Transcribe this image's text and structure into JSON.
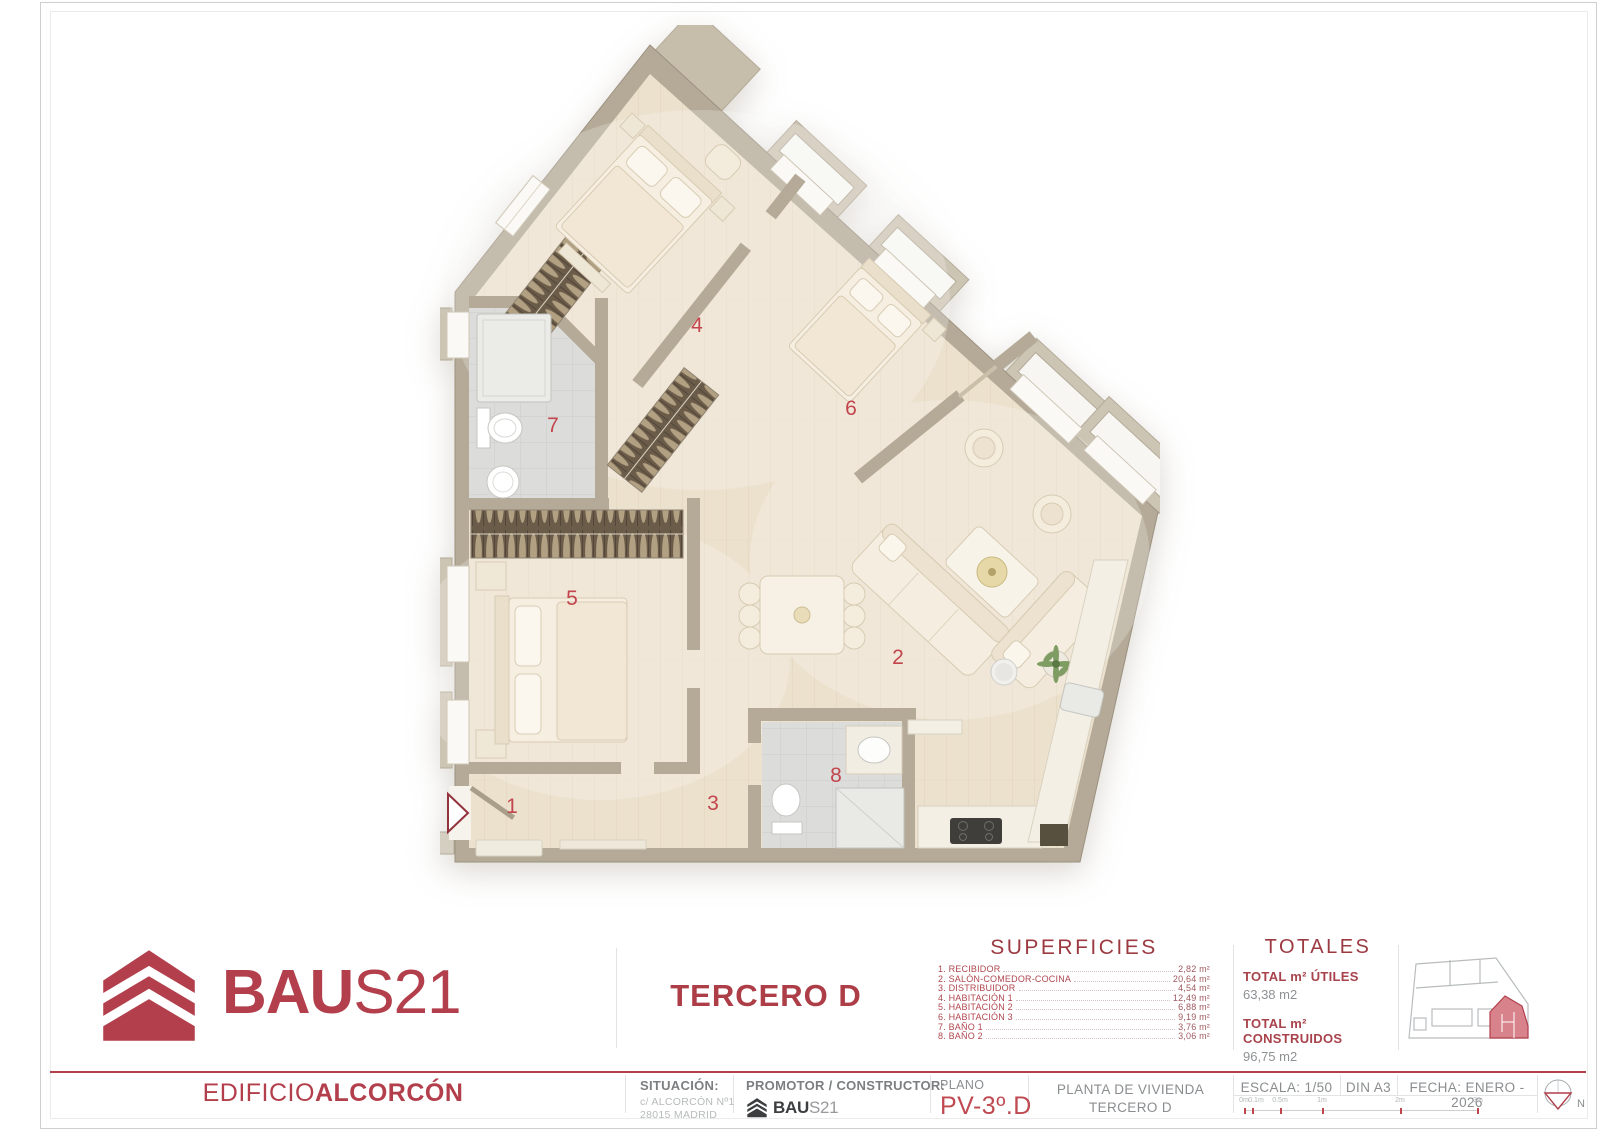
{
  "sheet": {
    "brand": {
      "logo_bold": "BAU",
      "logo_light": "S21"
    },
    "building": {
      "light": "EDIFICIO",
      "bold": "ALCORCÓN"
    },
    "unit_title": "TERCERO D",
    "entrance_label": "3º D",
    "north_label": "N",
    "superficies_title": "SUPERFICIES",
    "rooms": [
      {
        "num": "1",
        "label": "1. RECIBIDOR",
        "area": "2,82 m²"
      },
      {
        "num": "2",
        "label": "2. SALÓN-COMEDOR-COCINA",
        "area": "20,64 m²"
      },
      {
        "num": "3",
        "label": "3. DISTRIBUIDOR",
        "area": "4,54 m²"
      },
      {
        "num": "4",
        "label": "4. HABITACIÓN 1",
        "area": "12,49 m²"
      },
      {
        "num": "5",
        "label": "5. HABITACIÓN 2",
        "area": "6,88 m²"
      },
      {
        "num": "6",
        "label": "6. HABITACIÓN 3",
        "area": "9,19 m²"
      },
      {
        "num": "7",
        "label": "7. BAÑO 1",
        "area": "3,76 m²"
      },
      {
        "num": "8",
        "label": "8. BAÑO 2",
        "area": "3,06 m²"
      }
    ],
    "totales": {
      "title": "TOTALES",
      "utiles_label": "TOTAL m² ÚTILES",
      "utiles_value": "63,38 m2",
      "construidos_label": "TOTAL m² CONSTRUIDOS",
      "construidos_value": "96,75 m2"
    },
    "titleblock": {
      "situacion_label": "SITUACIÓN:",
      "situacion_address1": "c/ ALCORCÓN Nº1",
      "situacion_address2": "28015 MADRID",
      "promotor_label": "PROMOTOR / CONSTRUCTOR:",
      "plano_label": "PLANO",
      "plano_value": "PV-3º.D",
      "planta_line1": "PLANTA DE VIVIENDA",
      "planta_line2": "TERCERO D",
      "escala": "ESCALA: 1/50",
      "formato": "DIN A3",
      "fecha": "FECHA: ENERO - 2026",
      "scale_ticks": [
        "0m",
        "0.1m",
        "0.5m",
        "1m",
        "2m",
        "3m"
      ]
    },
    "colors": {
      "accent": "#b23f4b",
      "number_red": "#c3454d"
    }
  }
}
